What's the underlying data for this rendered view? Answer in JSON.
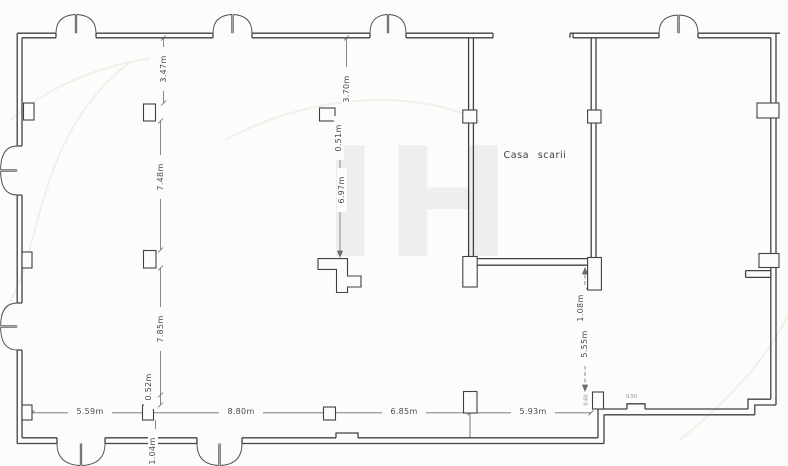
{
  "plan": {
    "room_label": "Casa scarii",
    "watermark": "IH",
    "dims": {
      "v_3_47": "3.47m",
      "v_7_48": "7.48m",
      "v_7_85": "7.85m",
      "v_0_52": "0.52m",
      "v_1_04": "1.04m",
      "v_3_70": "3.70m",
      "v_0_51": "0.51m",
      "v_6_97": "6.97m",
      "v_1_08": "1.08m",
      "v_5_55": "5.55m",
      "h_5_59": "5.59m",
      "h_8_80": "8.80m",
      "h_6_85": "6.85m",
      "h_5_93": "5.93m",
      "tiny_0_50": "0.50",
      "tiny_0_60": "0.60"
    }
  }
}
